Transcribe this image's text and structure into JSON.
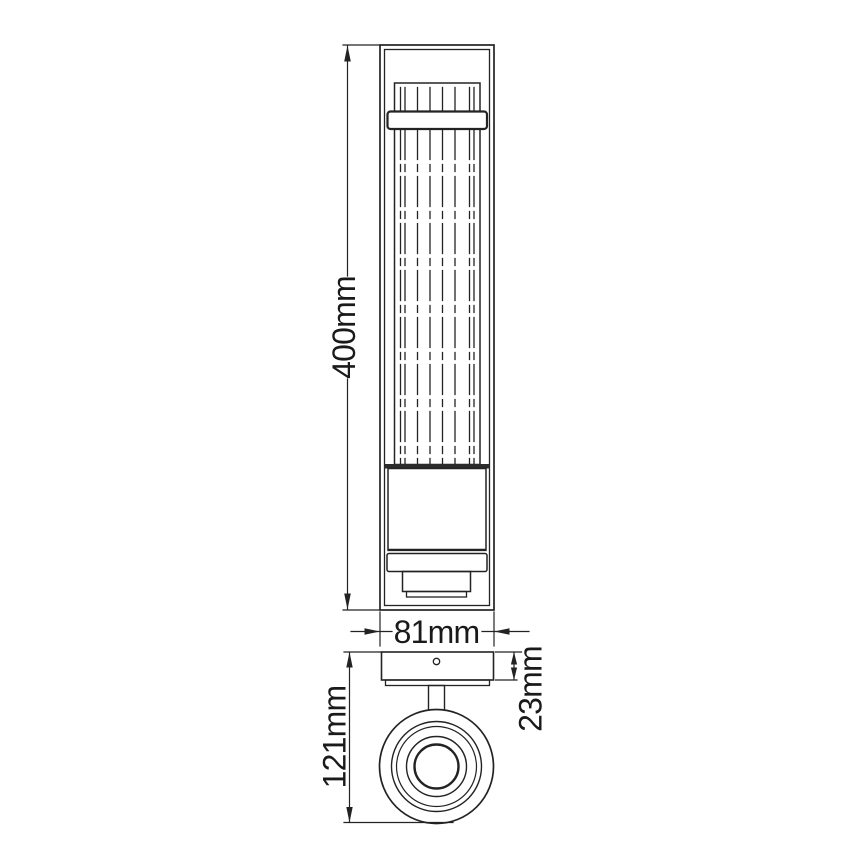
{
  "drawing": {
    "background": "#ffffff",
    "line_color": "#232323",
    "text_color": "#1a1a1a",
    "dimensions": {
      "height": {
        "label": "400mm"
      },
      "width": {
        "label": "81mm"
      },
      "overall_depth": {
        "label": "121mm"
      },
      "plate_depth": {
        "label": "23mm"
      }
    }
  }
}
